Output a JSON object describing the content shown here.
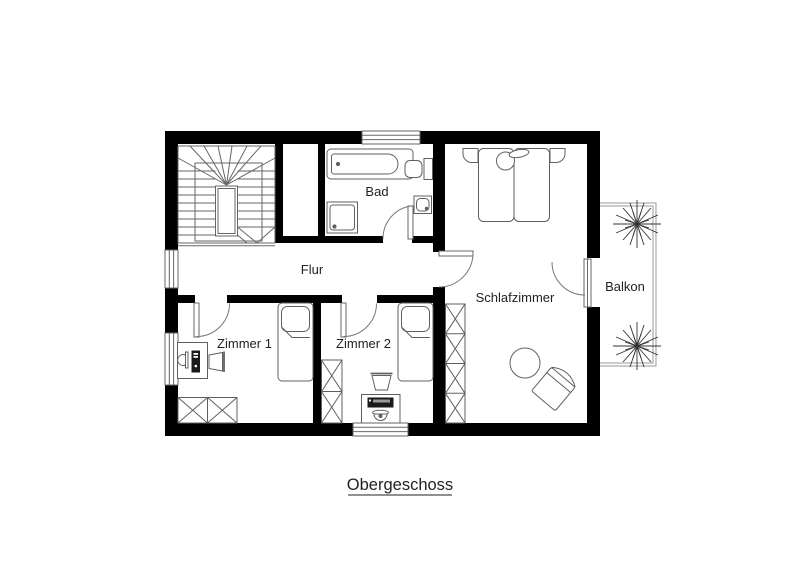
{
  "title": {
    "text": "Obergeschoss"
  },
  "rooms": [
    {
      "id": "flur",
      "label": "Flur"
    },
    {
      "id": "bad",
      "label": "Bad"
    },
    {
      "id": "schlafzimmer",
      "label": "Schlafzimmer"
    },
    {
      "id": "zimmer-1",
      "label": "Zimmer 1"
    },
    {
      "id": "zimmer-2",
      "label": "Zimmer 2"
    },
    {
      "id": "balkon",
      "label": "Balkon"
    }
  ],
  "symbols": [
    "staircase",
    "bathtub",
    "shower",
    "sink",
    "toilet",
    "door",
    "window",
    "double-bed",
    "single-bed",
    "nightstand",
    "wardrobe",
    "desk",
    "desk-chair",
    "monitor",
    "pc-tower",
    "laptop",
    "round-table",
    "armchair",
    "plant",
    "balcony-railing"
  ],
  "colors": {
    "wall": "#000000",
    "furniture_line": "#606060",
    "door_arc": "#777777",
    "railing": "#999999",
    "text": "#222222",
    "background": "#ffffff"
  }
}
